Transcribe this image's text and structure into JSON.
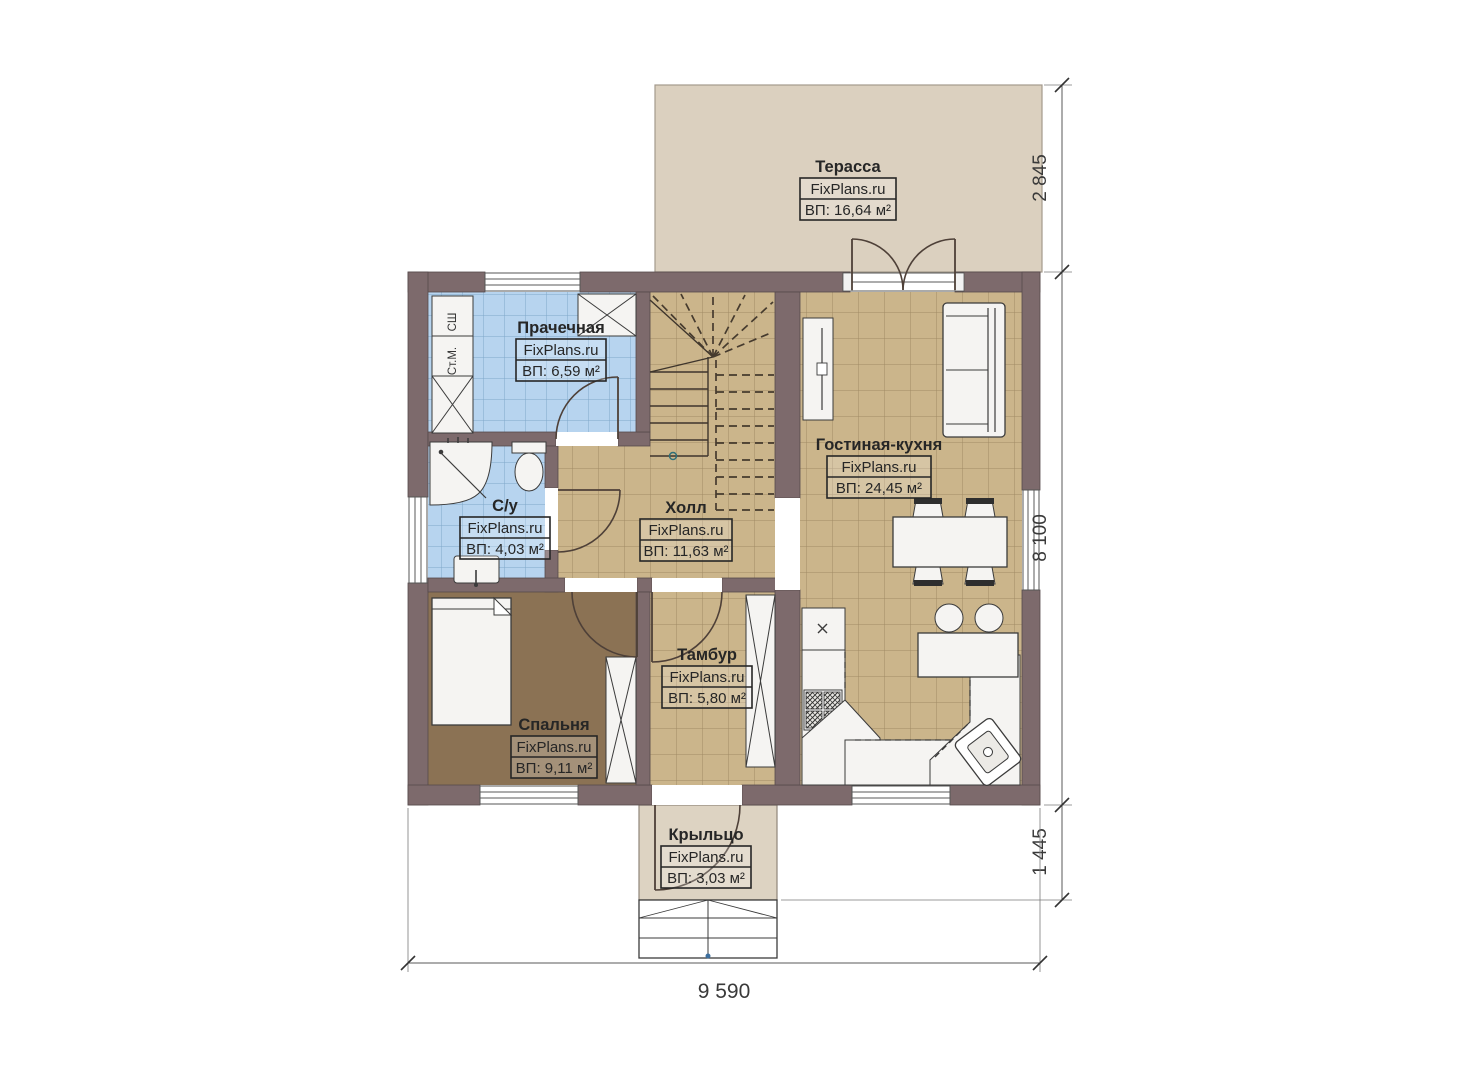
{
  "brand": "FixPlans.ru",
  "rooms": {
    "terrace": {
      "name": "Терасса",
      "brand": "FixPlans.ru",
      "area": "ВП: 16,64 м²"
    },
    "laundry": {
      "name": "Прачечная",
      "brand": "FixPlans.ru",
      "area": "ВП: 6,59 м²"
    },
    "bathroom": {
      "name": "С/у",
      "brand": "FixPlans.ru",
      "area": "ВП: 4,03 м²"
    },
    "hall": {
      "name": "Холл",
      "brand": "FixPlans.ru",
      "area": "ВП: 11,63 м²"
    },
    "living_kitchen": {
      "name": "Гостиная-кухня",
      "brand": "FixPlans.ru",
      "area": "ВП: 24,45 м²"
    },
    "bedroom": {
      "name": "Спальня",
      "brand": "FixPlans.ru",
      "area": "ВП: 9,11 м²"
    },
    "vestibule": {
      "name": "Тамбур",
      "brand": "FixPlans.ru",
      "area": "ВП: 5,80 м²"
    },
    "porch": {
      "name": "Крыльцо",
      "brand": "FixPlans.ru",
      "area": "ВП: 3,03 м²"
    }
  },
  "appliances": {
    "dryer_label": "СШ",
    "washer_label": "Ст.М."
  },
  "dimensions": {
    "terrace_depth": "2 845",
    "house_side": "8 100",
    "porch_depth": "1 445",
    "house_front": "9 590"
  },
  "colors": {
    "wall": "#7d6a6c",
    "floor_tile_tan": "#cbb58b",
    "floor_tile_blue": "#b7d4ef",
    "floor_bedroom": "#8b7254",
    "terrace_floor": "#dbd0bf",
    "background": "#ffffff"
  }
}
